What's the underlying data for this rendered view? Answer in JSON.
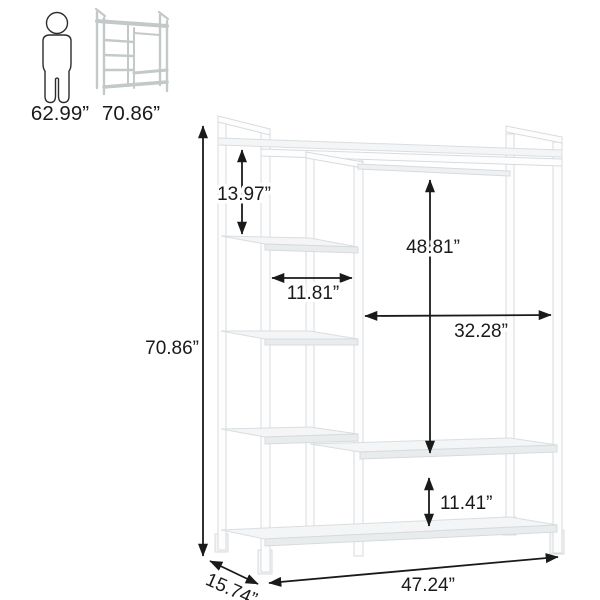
{
  "reference": {
    "person_label": "62.99”",
    "rack_label": "70.86”",
    "person_icon": "person-silhouette-icon",
    "rack_icon": "mini-garment-rack-icon"
  },
  "dims": {
    "overall_height": "70.86”",
    "top_compartment_height": "13.97”",
    "shelf_width": "11.81”",
    "hanging_height": "48.81”",
    "hanging_width": "32.28”",
    "bottom_gap": "11.41”",
    "overall_width": "47.24”",
    "depth": "15.74”"
  },
  "colors": {
    "dimension_line": "#1a1a1a",
    "text": "#1a1a1a",
    "rack_edge": "#d7dbdd",
    "rack_shade": "#e9eced",
    "thumbnail_gray": "#c3c8c9",
    "background": "#ffffff"
  }
}
